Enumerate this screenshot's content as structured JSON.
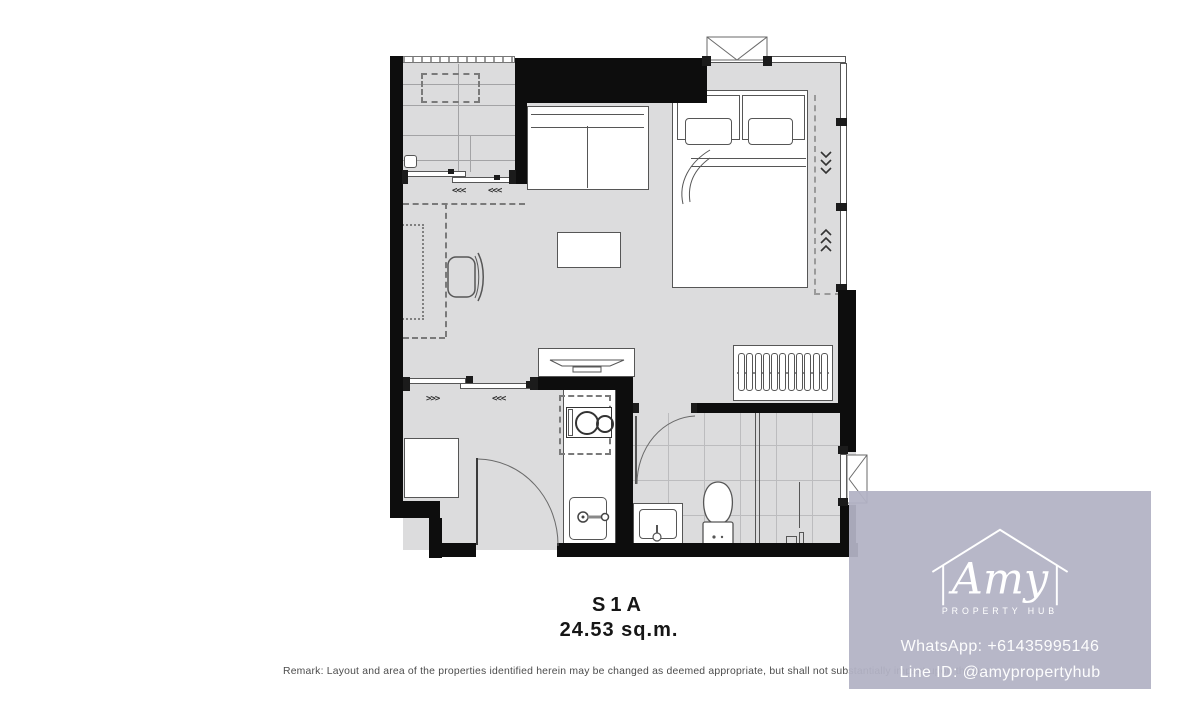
{
  "plan": {
    "unit_label": "S1A",
    "unit_area": "24.53 sq.m.",
    "markers": {
      "balcony_door_1": "<<<",
      "balcony_door_2": "<<<",
      "entry_slide_right": ">>>",
      "entry_slide_left": "<<<"
    }
  },
  "remark": "Remark: Layout and area of the properties identified herein may be changed as deemed appropriate, but shall not substantially impact upon the use.",
  "watermark": {
    "brand_script": "Amy",
    "brand_tagline": "PROPERTY HUB",
    "contact_whatsapp": "WhatsApp: +61435995146",
    "contact_line": "Line ID: @amypropertyhub",
    "panel_color": "#b2b2c5"
  },
  "colors": {
    "floor": "#dcdcdd",
    "wall": "#0d0d0d",
    "outline": "#565656",
    "tile_line": "#bcbcbe"
  }
}
